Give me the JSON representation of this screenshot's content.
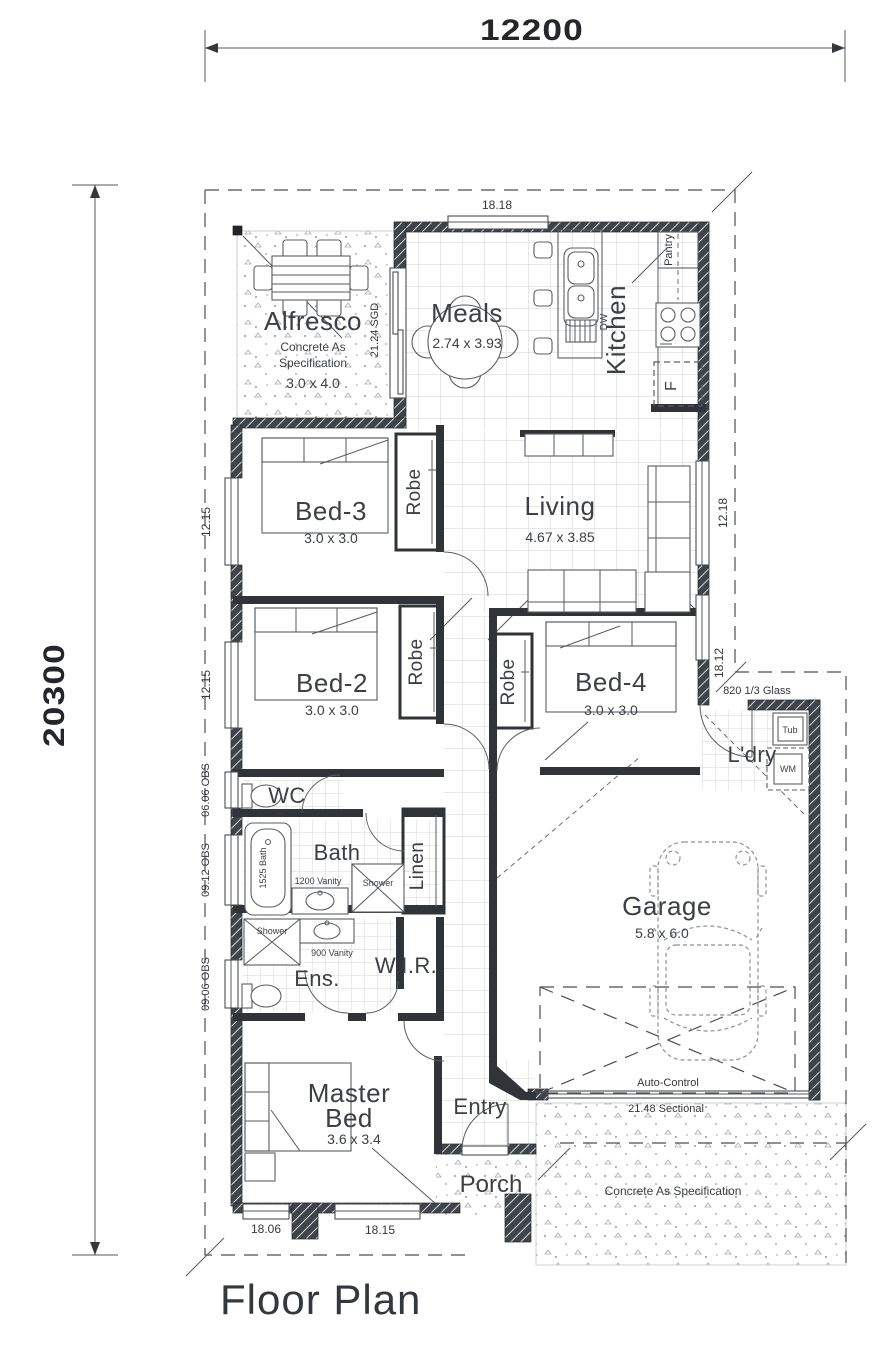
{
  "title": "Floor Plan",
  "overall_dimensions": {
    "width": "12200",
    "height": "20300"
  },
  "dims": {
    "meals_window": "18.18",
    "bed3_window": "12.15",
    "bed2_window": "12.15",
    "wc_window": "06.06 OBS",
    "bath_window": "09.12 OBS",
    "ens_window": "09.06 OBS",
    "living_window": "12.18",
    "bed4_window": "18.12",
    "master_window_1": "18.06",
    "master_window_2": "18.15",
    "alfresco_sgd": "21.24 SGD",
    "ldry_door": "820 1/3 Glass",
    "garage_door_line1": "Auto-Control",
    "garage_door_line2": "21.48 Sectional"
  },
  "rooms": {
    "alfresco": {
      "name": "Alfresco",
      "note1": "Concrete As",
      "note2": "Specification",
      "size": "3.0 x 4.0"
    },
    "meals": {
      "name": "Meals",
      "size": "2.74 x 3.93"
    },
    "kitchen": {
      "name": "Kitchen"
    },
    "pantry": {
      "name": "Pantry"
    },
    "living": {
      "name": "Living",
      "size": "4.67 x 3.85"
    },
    "bed3": {
      "name": "Bed-3",
      "size": "3.0 x 3.0"
    },
    "bed2": {
      "name": "Bed-2",
      "size": "3.0 x 3.0"
    },
    "bed4": {
      "name": "Bed-4",
      "size": "3.0 x 3.0"
    },
    "master": {
      "name1": "Master",
      "name2": "Bed",
      "size": "3.6 x 3.4"
    },
    "garage": {
      "name": "Garage",
      "size": "5.8 x 6.0"
    },
    "wc": {
      "name": "WC"
    },
    "bath": {
      "name": "Bath"
    },
    "ens": {
      "name": "Ens."
    },
    "wir": {
      "name": "W.I.R."
    },
    "linen": {
      "name": "Linen"
    },
    "ldry": {
      "name": "L'dry"
    },
    "entry": {
      "name": "Entry"
    },
    "porch": {
      "name": "Porch"
    },
    "robe": "Robe"
  },
  "fixtures": {
    "bath_tub": "1525 Bath",
    "bath_vanity": "1200 Vanity",
    "bath_shower": "Shower",
    "ens_vanity": "900 Vanity",
    "ens_shower": "Shower",
    "dishwasher": "DW",
    "fridge": "F",
    "laundry_tub": "Tub",
    "washing_machine": "WM"
  },
  "notes": {
    "driveway": "Concrete As Specification"
  },
  "colors": {
    "wall_hatch": "#3f434a",
    "interior_wall": "#303338",
    "dim_text": "#24262b",
    "label_text": "#3c4046",
    "tile_line": "#d2d2d2",
    "stipple": "#a9a9a9"
  }
}
